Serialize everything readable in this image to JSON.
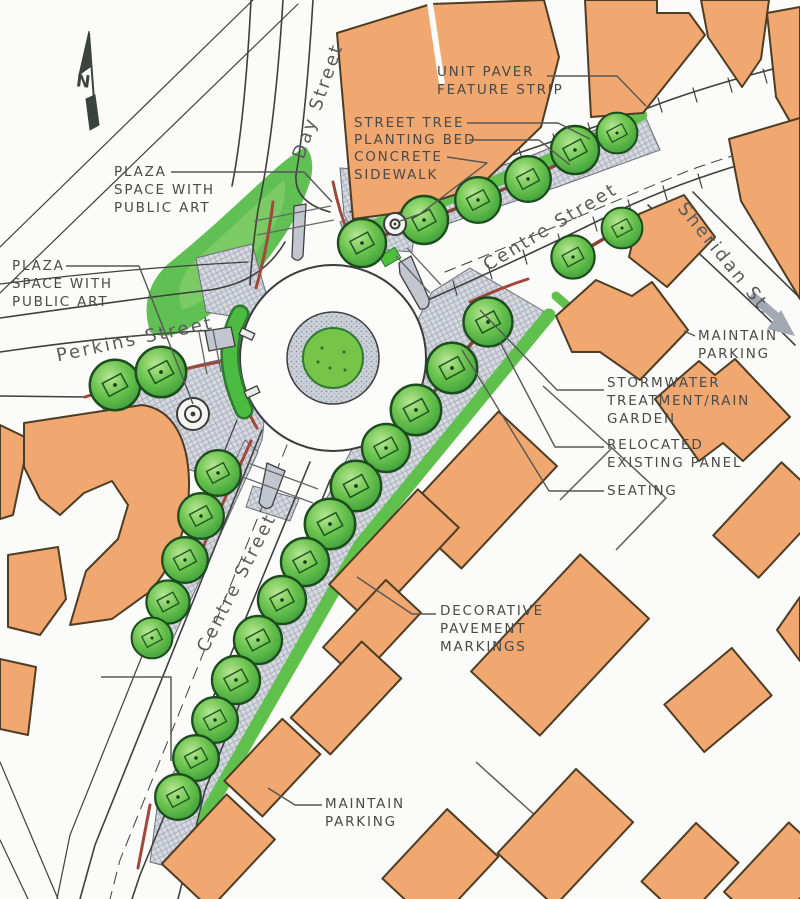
{
  "map": {
    "north_label": "N",
    "streets": [
      {
        "id": "day-street",
        "name": "Day Street"
      },
      {
        "id": "centre-street-ne",
        "name": "Centre Street"
      },
      {
        "id": "sheridan-st",
        "name": "Sheridan St."
      },
      {
        "id": "perkins-street",
        "name": "Perkins Street"
      },
      {
        "id": "centre-street-s",
        "name": "Centre Street"
      }
    ],
    "annotations": [
      {
        "id": "unit-paver-feature-strip",
        "text": "UNIT PAVER\nFEATURE STRIP"
      },
      {
        "id": "street-tree",
        "text": "STREET TREE"
      },
      {
        "id": "planting-bed",
        "text": "PLANTING BED"
      },
      {
        "id": "concrete-sidewalk",
        "text": "CONCRETE\nSIDEWALK"
      },
      {
        "id": "plaza-space-upper",
        "text": "PLAZA\nSPACE WITH\nPUBLIC ART"
      },
      {
        "id": "plaza-space-lower",
        "text": "PLAZA\nSPACE WITH\nPUBLIC ART"
      },
      {
        "id": "maintain-parking-ne",
        "text": "MAINTAIN\nPARKING"
      },
      {
        "id": "stormwater-rain-garden",
        "text": "STORMWATER\nTREATMENT/RAIN\nGARDEN"
      },
      {
        "id": "relocated-existing-panel",
        "text": "RELOCATED\nEXISTING PANEL"
      },
      {
        "id": "seating",
        "text": "SEATING"
      },
      {
        "id": "decorative-pavement-markings",
        "text": "DECORATIVE\nPAVEMENT\nMARKINGS"
      },
      {
        "id": "maintain-parking-south",
        "text": "MAINTAIN\nPARKING"
      }
    ],
    "legend_colors": {
      "building": "#f0a770",
      "tree_canopy": "#4cae3e",
      "plaza_paving": "#d6d9e0",
      "lawn": "#54bb45",
      "curb_accent": "#a1473b",
      "road": "#fcfcfa",
      "annotation_text": "#4a4a4a"
    }
  }
}
